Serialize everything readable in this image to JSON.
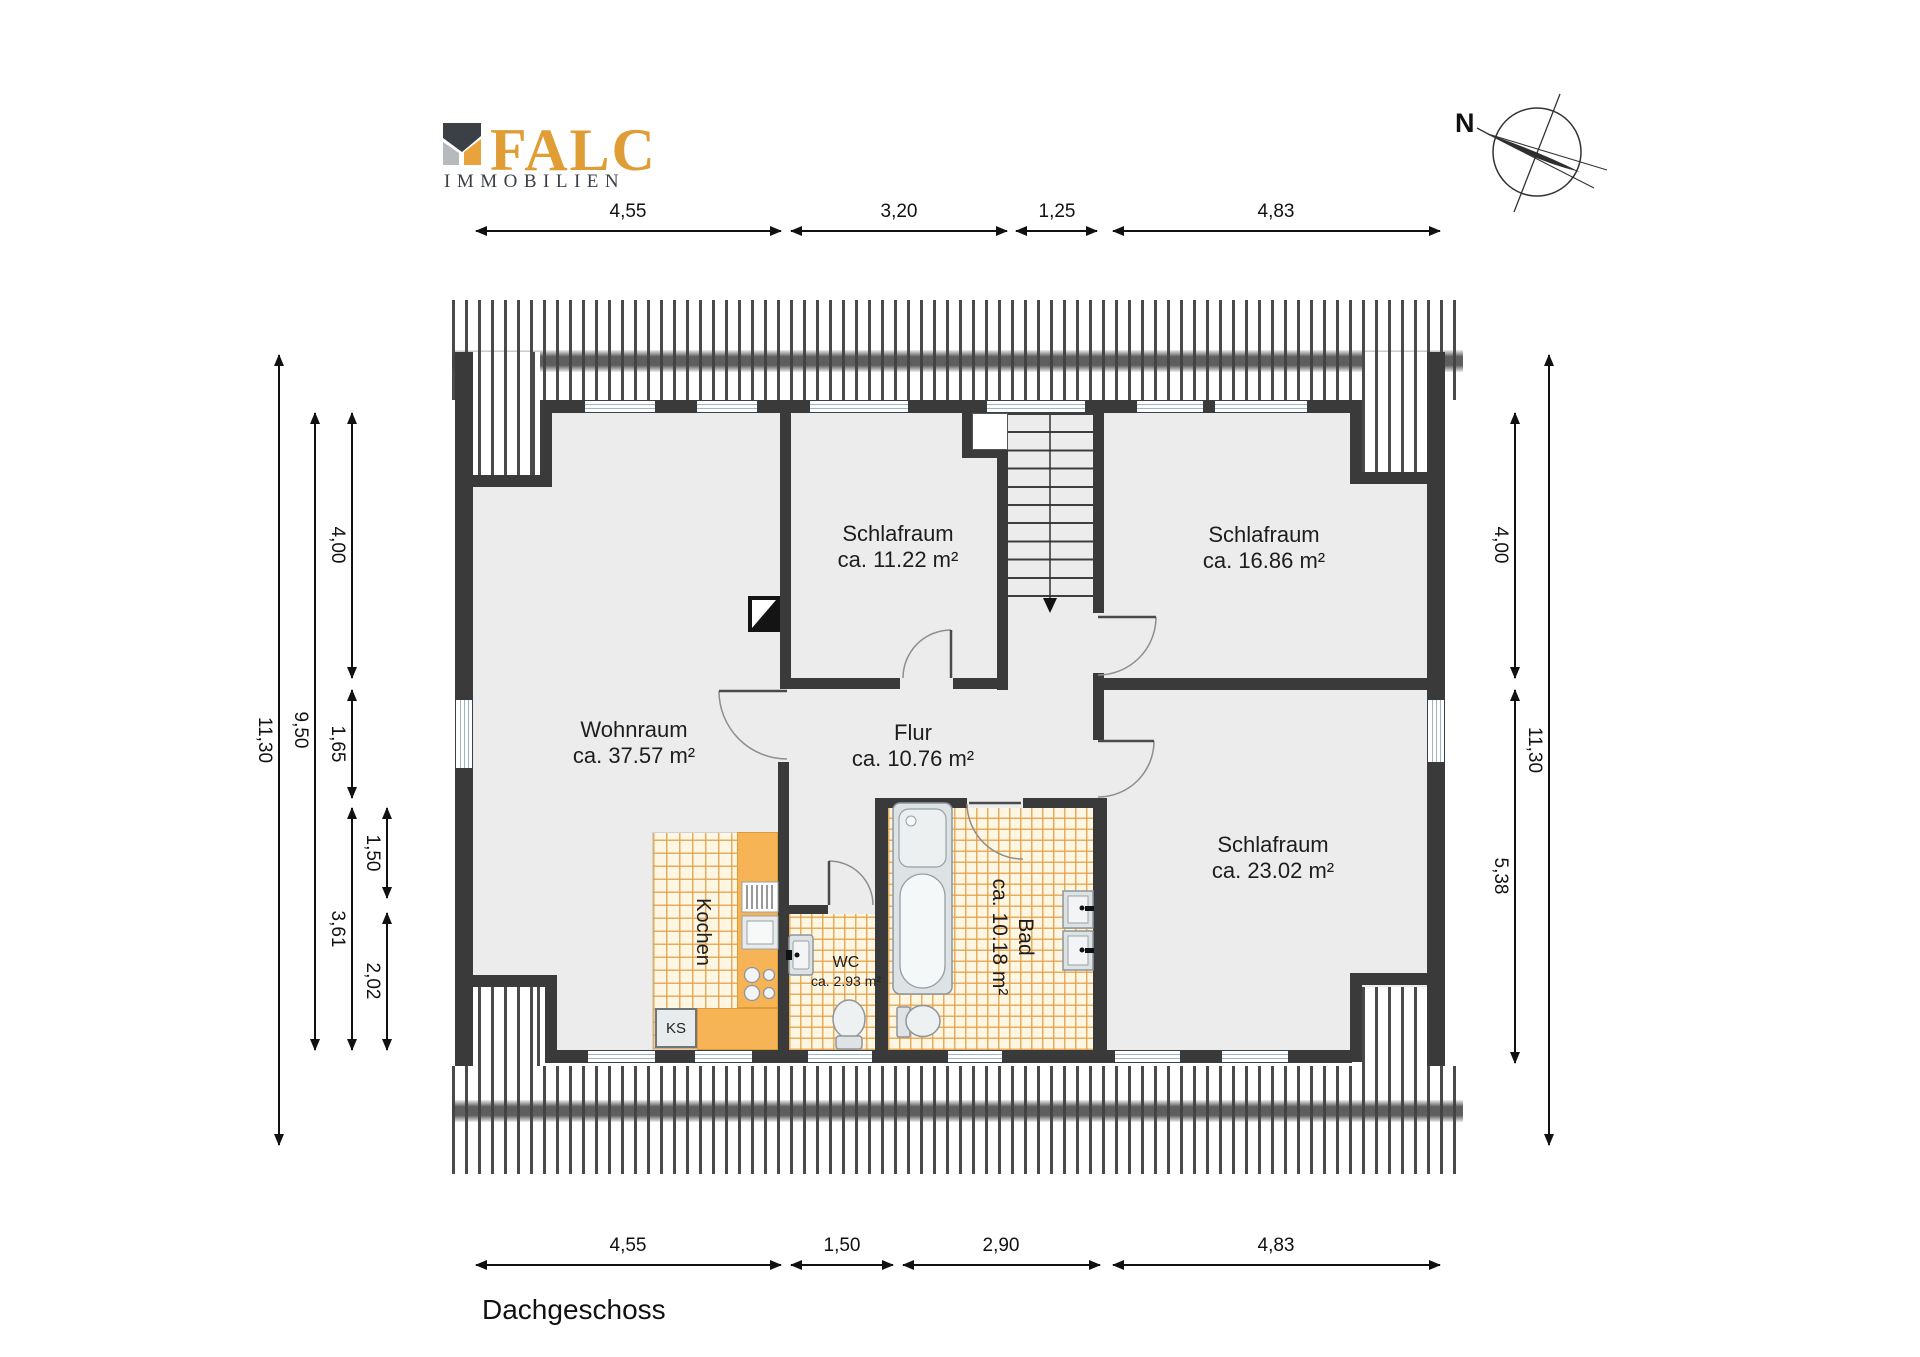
{
  "logo": {
    "name": "FALC",
    "subtitle": "IMMOBILIEN"
  },
  "compass": {
    "label": "N"
  },
  "title": "Dachgeschoss",
  "rooms": {
    "schlafraum1": {
      "name": "Schlafraum",
      "area": "ca. 11.22 m²"
    },
    "schlafraum2": {
      "name": "Schlafraum",
      "area": "ca. 16.86 m²"
    },
    "schlafraum3": {
      "name": "Schlafraum",
      "area": "ca. 23.02 m²"
    },
    "wohnraum": {
      "name": "Wohnraum",
      "area": "ca. 37.57 m²"
    },
    "flur": {
      "name": "Flur",
      "area": "ca. 10.76 m²"
    },
    "wc": {
      "name": "WC",
      "area": "ca. 2.93 m²"
    },
    "bad": {
      "name": "Bad",
      "area": "ca. 10.18 m²"
    },
    "kochen": {
      "name": "Kochen"
    },
    "ks": {
      "name": "KS"
    }
  },
  "dimensions": {
    "top": [
      "4,55",
      "3,20",
      "1,25",
      "4,83"
    ],
    "bottom": [
      "4,55",
      "1,50",
      "2,90",
      "4,83"
    ],
    "left": {
      "overall": "11,30",
      "inner": "9,50",
      "col3": [
        "4,00",
        "1,65",
        "3,61"
      ],
      "col4": [
        "1,50",
        "2,02"
      ]
    },
    "right": {
      "col1": [
        "4,00",
        "5,38"
      ],
      "overall": "11,30"
    }
  },
  "colors": {
    "wall": "#3a3a3a",
    "floor": "#ececec",
    "tile_line": "#e4a048",
    "cabinet": "#f6b457",
    "logo_orange": "#e8a33d",
    "logo_dark": "#3b3f46"
  }
}
